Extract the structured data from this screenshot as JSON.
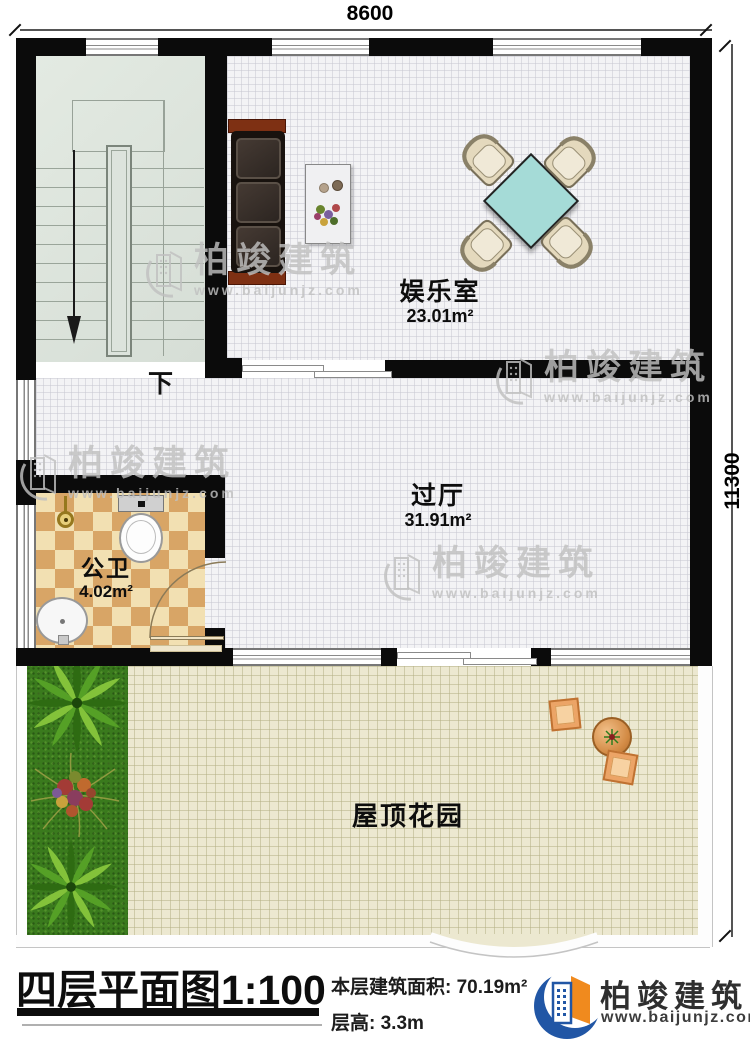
{
  "plan": {
    "dim_width": "8600",
    "dim_height": "11300",
    "stair_down": "下"
  },
  "rooms": {
    "entertainment": {
      "name": "娱乐室",
      "area": "23.01m²"
    },
    "hallway": {
      "name": "过厅",
      "area": "31.91m²"
    },
    "bathroom": {
      "name": "公卫",
      "area": "4.02m²"
    },
    "garden": {
      "name": "屋顶花园"
    }
  },
  "title_block": {
    "title": "四层平面图",
    "scale": "1:100",
    "area_label": "本层建筑面积:",
    "area_value": "70.19m²",
    "height_label": "层高:",
    "height_value": "3.3m"
  },
  "branding": {
    "company": "柏竣建筑",
    "website": "www.baijunjz.com"
  },
  "watermark": {
    "company": "柏竣建筑",
    "website": "www.baijunjz.com"
  },
  "colors": {
    "wall": "#0b0b0b",
    "logo_blue": "#2156a5",
    "logo_orange": "#f08a1e",
    "table_cyan": "#a5dbd7",
    "bath_tile": "#d8a566"
  }
}
